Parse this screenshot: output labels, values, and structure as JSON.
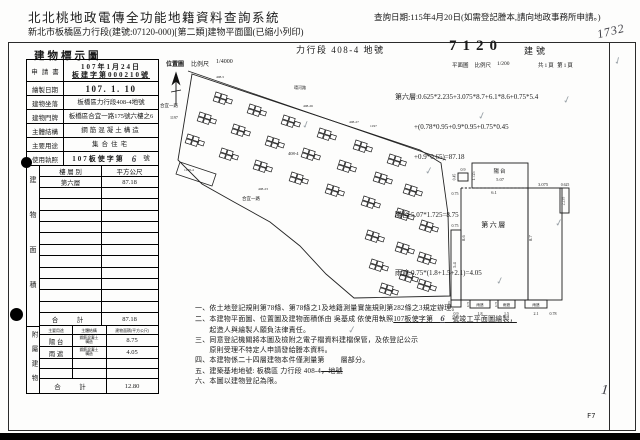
{
  "colors": {
    "paper": "#ffffff",
    "ink": "#1b1b1b",
    "handwriting": "#3b3b42",
    "checkmark": "#9aa2a8"
  },
  "header": {
    "system_title": "北北桃地政電傳全功能地籍資料查詢系統",
    "query_date": "查詢日期:115年4月20日(如需登記謄本,請向地政事務所申請。)",
    "subtitle": "新北市板橋區力行段(建號:07120-000)[第二類]建物平面圖(已縮小列印)"
  },
  "doc": {
    "title": "建物標示圖",
    "land_section": "力行段  408-4 地號",
    "building_no": "7120",
    "building_no_label": "建號",
    "hand_top": "1732",
    "hand_bottom": "1",
    "page_code": "F7"
  },
  "form": {
    "rows": [
      {
        "label": "申請書",
        "value": "107年1月24日",
        "value2": "板建字第000210號"
      },
      {
        "label": "繪製日期",
        "value": "107. 1. 10"
      },
      {
        "label": "建物坐落",
        "value": "板橋區力行段408-4地號"
      },
      {
        "label": "建物門牌",
        "value": "板橋區合宜一路175號六樓之6"
      },
      {
        "label": "主體結構",
        "value": "鋼筋混凝土構造"
      },
      {
        "label": "主要用途",
        "value": "集合住宅"
      },
      {
        "label": "使用執照",
        "value": "107板使字第",
        "value2": "6",
        "value3": "號"
      }
    ]
  },
  "area_table": {
    "vertical_label": "建物面積",
    "col_floor": "樓 層 別",
    "col_area": "平方公尺",
    "floor": "第六層",
    "floor_area": "87.18",
    "total_label": "合　計",
    "total": "87.18"
  },
  "annex_table": {
    "vertical_label": "附屬建物",
    "col_use": "主要用途",
    "col_structure": "主體結構",
    "col_area": "建物面積(平方公尺)",
    "rows": [
      {
        "use": "陽 台",
        "structure": "鋼筋混凝土構造",
        "area": "8.75"
      },
      {
        "use": "雨 遮",
        "structure": "鋼筋混凝土構造",
        "area": "4.05"
      }
    ],
    "total_label": "合　計",
    "total": "12.80"
  },
  "map": {
    "title": "位置圖",
    "scale_label": "比例尺",
    "scale": "1/4000",
    "labels": {
      "road_west": "合宜一路",
      "road_south": "合宜一路",
      "road_north": "環河路",
      "lot_1197": "1197",
      "lot_408_5": "408-5",
      "lot_408_26": "408-26",
      "lot_408_27": "408-27",
      "lot_408_4": "408-4",
      "lot_1198_4": "1198-4",
      "lot_408_23": "408-23"
    }
  },
  "plan": {
    "title": "平面圖",
    "scale_label": "比例尺",
    "scale": "1/200",
    "pages": "共1頁 第1頁",
    "floor_label": "第六層",
    "balcony_label": "陽台",
    "canopy_label": "雨遮",
    "dims": {
      "d507": "5.07",
      "d1725": "1.725",
      "d09": "0.9",
      "d045": "0.45",
      "d075": "0.75",
      "d61": "6.1",
      "d3075": "3.075",
      "d0625": "0.625",
      "d2235": "2.235",
      "d86": "8.6",
      "d87": "8.7",
      "d54": "5.4",
      "d065": "0.65",
      "d18": "1.8",
      "d15": "1.5",
      "d21": "2.1",
      "d078": "0.78"
    }
  },
  "calc": {
    "floor_line1": "第六層:0.625*2.235+3.075*8.7+6.1*8.6+0.75*5.4",
    "floor_line2": "+(0.78*0.95+0.9*0.95+0.75*0.45",
    "floor_line3": "+0.9*0.65)=87.18",
    "balcony": "陽台:5.07*1.725=8.75",
    "canopy": "雨遮:0.75*(1.8+1.5+2.1)=4.05"
  },
  "notes": {
    "n1": "一、依土地登記規則第78條、第78條之1及地籍測量實施規則第282條之3規定辦理。",
    "n2a": "二、本建物平面圖、位置圖及建物面積係由 吳基成 依使用執照",
    "n2b_pre": "107板使字第　",
    "n2b_num": "6",
    "n2b_post": "　號竣工平面圖繪製，",
    "n3": "　　起造人與繪製人願負法律責任。",
    "n4": "三、同意登記機關將本圖及檢附之電子檔資料建檔保管，及依登記公示",
    "n5": "　　原則受理不特定人申請發給謄本資料。",
    "n6a": "四、本建物係二十四層建物本件僅測量第",
    "n6b": "層部分。",
    "n7a": "五、建築基地地號:  板橋區  力行段  408-4",
    "n7b": "，地號",
    "n8": "六、本圖以建物登記為限。"
  }
}
